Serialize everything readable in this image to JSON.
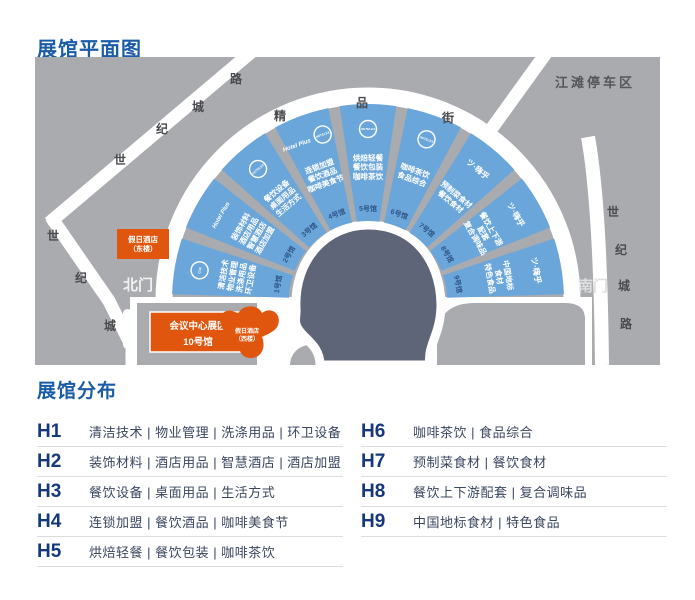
{
  "page": {
    "map_title": "展馆平面图",
    "legend_title": "展馆分布"
  },
  "map": {
    "parking_label": "江滩停车区",
    "north_gate": "北门",
    "south_gate": "南门",
    "street_chars": [
      "精",
      "品",
      "街"
    ],
    "road_nw_chars": [
      "世",
      "纪",
      "城",
      "路"
    ],
    "road_left_chars": [
      "世",
      "纪",
      "城"
    ],
    "road_right_chars": [
      "世",
      "纪",
      "城",
      "路"
    ],
    "hotel_east": {
      "line1": "假日酒店",
      "line2": "（东楼）"
    },
    "hotel_west": {
      "line1": "假日酒店",
      "line2": "（西楼）"
    },
    "conference": {
      "line1": "会议中心展区",
      "line2": "10号馆"
    },
    "halls": [
      {
        "no": "1号馆",
        "logos": [
          {
            "style": "ring",
            "text": "CCE"
          }
        ],
        "lines": [
          "清洁技术",
          "物业管理",
          "洗涤用品",
          "环卫设备"
        ]
      },
      {
        "no": "2号馆",
        "logos": [
          {
            "style": "swoosh",
            "text": "Hotel Plus"
          }
        ],
        "lines": [
          "装饰材料",
          "酒店用品",
          "智慧酒店",
          "酒店加盟"
        ]
      },
      {
        "no": "3号馆",
        "logos": [
          {
            "style": "ring",
            "text": "HOTELEX"
          }
        ],
        "lines": [
          "餐饮设备",
          "桌面用品",
          "生活方式"
        ]
      },
      {
        "no": "4号馆",
        "logos": [
          {
            "style": "swoosh",
            "text": "Hotel Plus"
          },
          {
            "style": "ring",
            "text": "HOTELEX"
          }
        ],
        "lines": [
          "连锁加盟",
          "餐饮酒品",
          "咖啡美食节"
        ]
      },
      {
        "no": "5号馆",
        "logos": [
          {
            "style": "ring",
            "text": "HOTELEX"
          }
        ],
        "lines": [
          "烘焙轻餐",
          "餐饮包装",
          "咖啡茶饮"
        ]
      },
      {
        "no": "6号馆",
        "logos": [
          {
            "style": "ring",
            "text": "HOTELEX"
          }
        ],
        "lines": [
          "咖啡茶饮",
          "食品综合"
        ]
      },
      {
        "no": "7号馆",
        "logos": [
          {
            "style": "hi",
            "text": "ツ·嗨乎"
          }
        ],
        "lines": [
          "预制菜食材",
          "餐饮食材"
        ]
      },
      {
        "no": "8号馆",
        "logos": [
          {
            "style": "hi",
            "text": "ツ·嗨乎"
          }
        ],
        "lines": [
          "餐饮上下游",
          "配套",
          "复合调味品"
        ]
      },
      {
        "no": "9号馆",
        "logos": [
          {
            "style": "hi",
            "text": "ツ·嗨乎"
          }
        ],
        "lines": [
          "中国地标",
          "食材",
          "特色食品"
        ]
      }
    ],
    "colors": {
      "map_background": "#A9ABAE",
      "hall_blue": "#6BA6DB",
      "center_blob": "#5E6579",
      "accent_orange": "#E1560E",
      "title_blue": "#1A5CA8",
      "hall_number_text": "#2E5687"
    }
  },
  "legend": {
    "left": [
      {
        "no": "H1",
        "cats": "清洁技术 | 物业管理 | 洗涤用品 | 环卫设备"
      },
      {
        "no": "H2",
        "cats": "装饰材料 | 酒店用品 | 智慧酒店 | 酒店加盟"
      },
      {
        "no": "H3",
        "cats": "餐饮设备 | 桌面用品 | 生活方式"
      },
      {
        "no": "H4",
        "cats": "连锁加盟 | 餐饮酒品 | 咖啡美食节"
      },
      {
        "no": "H5",
        "cats": "烘焙轻餐 | 餐饮包装 | 咖啡茶饮"
      }
    ],
    "right": [
      {
        "no": "H6",
        "cats": "咖啡茶饮 | 食品综合"
      },
      {
        "no": "H7",
        "cats": "预制菜食材 | 餐饮食材"
      },
      {
        "no": "H8",
        "cats": "餐饮上下游配套 | 复合调味品"
      },
      {
        "no": "H9",
        "cats": "中国地标食材 | 特色食品"
      }
    ]
  }
}
